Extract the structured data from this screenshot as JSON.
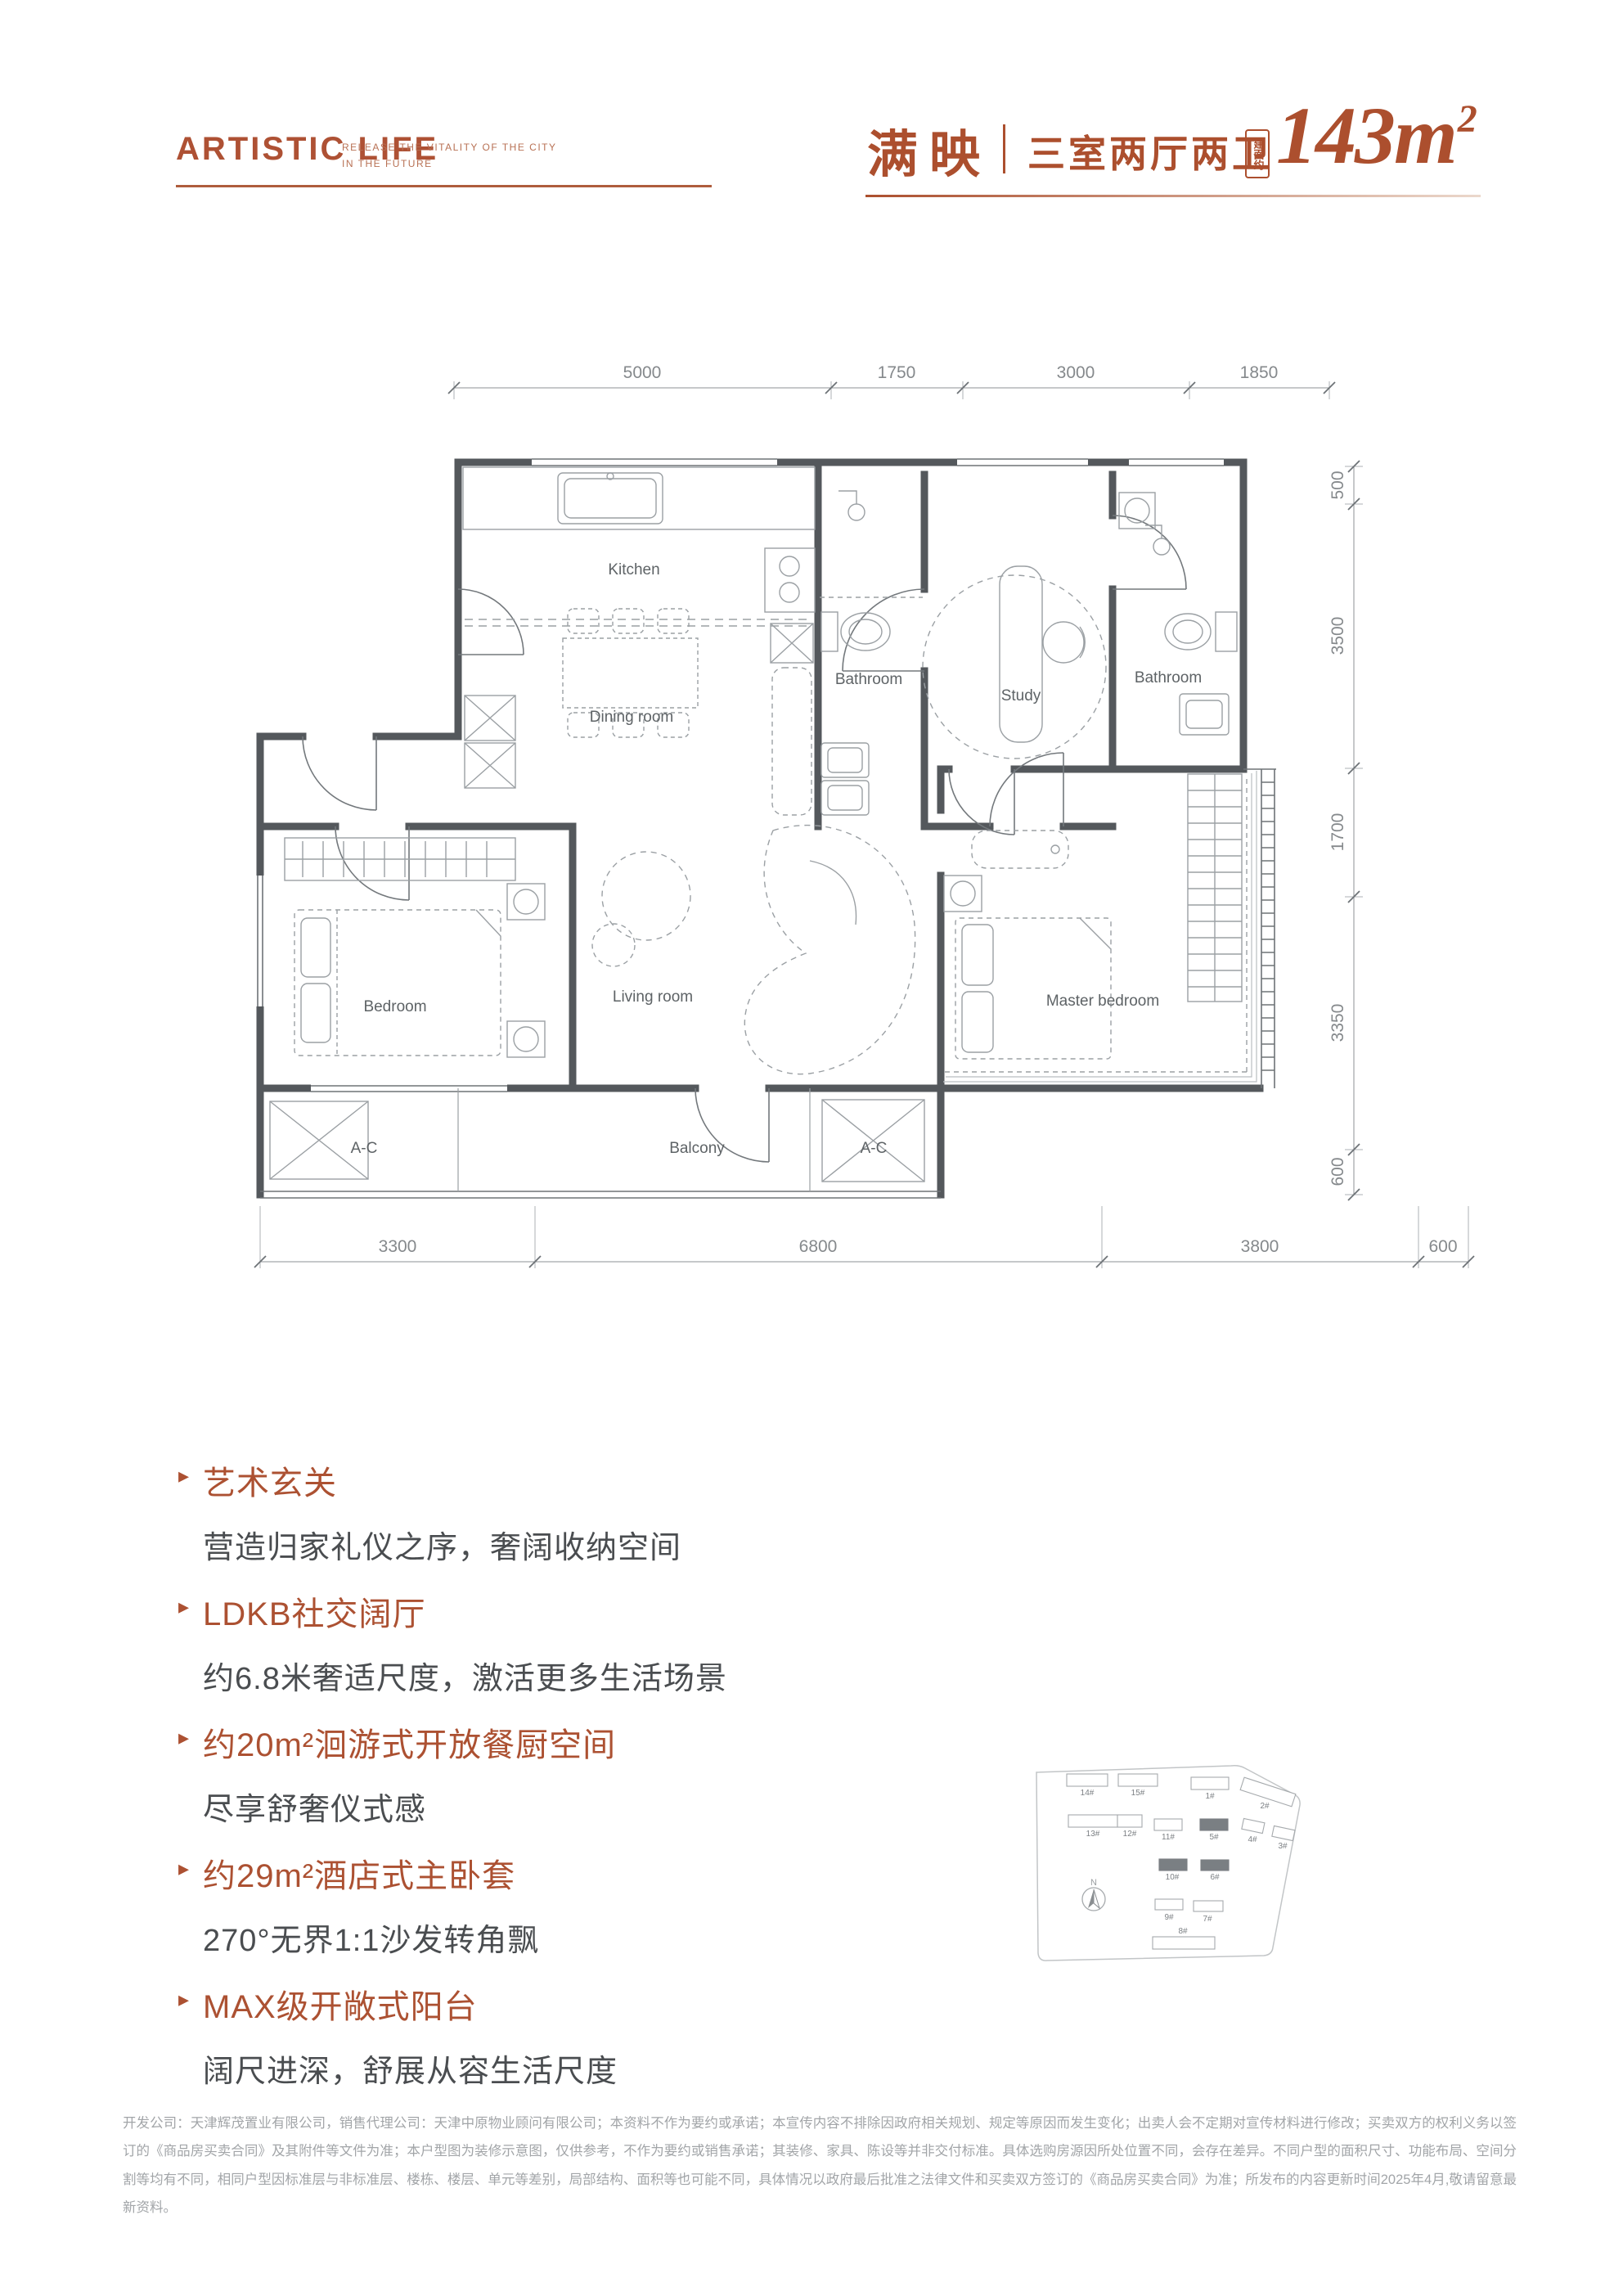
{
  "header": {
    "logo_title": "ARTISTIC LIFE",
    "logo_subtitle_line1": "RELEASE THE VITALITY OF THE CITY",
    "logo_subtitle_line2": "IN THE FUTURE",
    "plan_name": "满映",
    "layout_type": "三室两厅两卫",
    "area_badge": "建面约",
    "area_number": "143",
    "area_unit": "m",
    "area_sup": "2"
  },
  "colors": {
    "accent": "#AC4F2E",
    "wall": "#54585C",
    "highlight_building": "#7A7F83"
  },
  "floor_plan": {
    "rooms": [
      "Kitchen",
      "Dining room",
      "Bathroom",
      "Study",
      "Bathroom",
      "Bedroom",
      "Living room",
      "Master bedroom",
      "A-C",
      "Balcony",
      "A-C"
    ],
    "dims_top": [
      "5000",
      "1750",
      "3000",
      "1850"
    ],
    "dims_right": [
      "500",
      "3500",
      "1700",
      "3350",
      "600"
    ],
    "dims_bottom": [
      "3300",
      "6800",
      "3800",
      "600"
    ]
  },
  "features": [
    {
      "title": "艺术玄关",
      "desc": "营造归家礼仪之序，奢阔收纳空间"
    },
    {
      "title": "LDKB社交阔厅",
      "desc": "约6.8米奢适尺度，激活更多生活场景"
    },
    {
      "title": "约20m²洄游式开放餐厨空间",
      "desc": "尽享舒奢仪式感"
    },
    {
      "title": "约29m²酒店式主卧套",
      "desc": "270°无界1:1沙发转角飘"
    },
    {
      "title": "MAX级开敞式阳台",
      "desc": "阔尺进深，舒展从容生活尺度"
    }
  ],
  "site_plan": {
    "compass": "N",
    "buildings": [
      {
        "label": "14#"
      },
      {
        "label": "15#"
      },
      {
        "label": "1#"
      },
      {
        "label": "2#"
      },
      {
        "label": "13#"
      },
      {
        "label": "12#"
      },
      {
        "label": "11#"
      },
      {
        "label": "5#",
        "highlighted": true
      },
      {
        "label": "4#"
      },
      {
        "label": "3#"
      },
      {
        "label": "10#",
        "highlighted": true
      },
      {
        "label": "6#",
        "highlighted": true
      },
      {
        "label": "9#"
      },
      {
        "label": "7#"
      },
      {
        "label": "8#"
      }
    ]
  },
  "disclaimer": {
    "text": "开发公司：天津辉茂置业有限公司，销售代理公司：天津中原物业顾问有限公司；本资料不作为要约或承诺；本宣传内容不排除因政府相关规划、规定等原因而发生变化；出卖人会不定期对宣传材料进行修改；买卖双方的权利义务以签订的《商品房买卖合同》及其附件等文件为准；本户型图为装修示意图，仅供参考，不作为要约或销售承诺；其装修、家具、陈设等并非交付标准。具体选购房源因所处位置不同，会存在差异。不同户型的面积尺寸、功能布局、空间分割等均有不同，相同户型因标准层与非标准层、楼栋、楼层、单元等差别，局部结构、面积等也可能不同，具体情况以政府最后批准之法律文件和买卖双方签订的《商品房买卖合同》为准；所发布的内容更新时间2025年4月,敬请留意最新资料。"
  }
}
